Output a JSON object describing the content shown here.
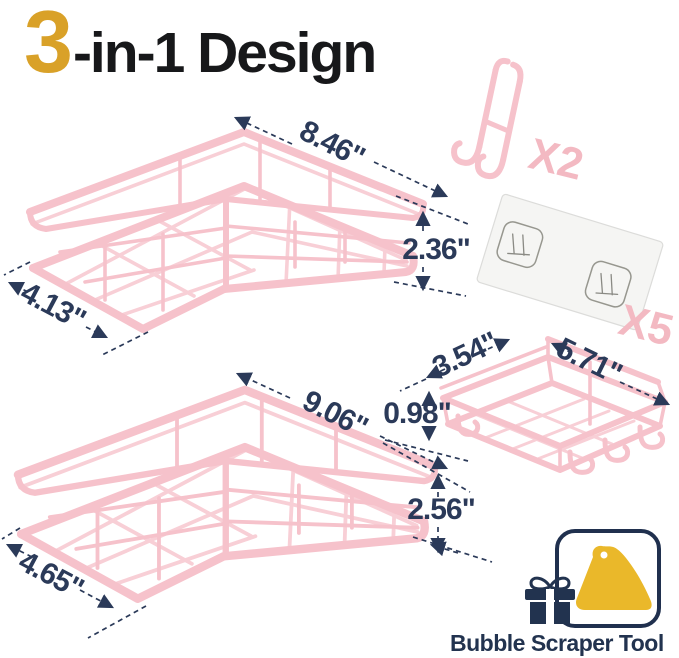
{
  "title": {
    "big": "3",
    "rest": "-in-1 Design"
  },
  "colors": {
    "accent_gold": "#D9A128",
    "title_black": "#17181A",
    "product_pink": "#F6C2CB",
    "dimension_navy": "#2B3A59",
    "count_pink": "#F3B9C2",
    "scraper_yellow": "#EAB82A",
    "badge_navy": "#22334F"
  },
  "top_corner_shelf": {
    "width": "8.46\"",
    "height": "2.36\"",
    "depth": "4.13\""
  },
  "bottom_corner_shelf": {
    "width": "9.06\"",
    "height": "2.56\"",
    "depth": "4.65\""
  },
  "soap_dish_shelf": {
    "depth": "3.54\"",
    "width": "5.71\"",
    "height": "0.98\""
  },
  "hooks": {
    "count": "X2"
  },
  "adhesive_sheets": {
    "count": "X5"
  },
  "badge": {
    "label": "Bubble Scraper Tool"
  }
}
